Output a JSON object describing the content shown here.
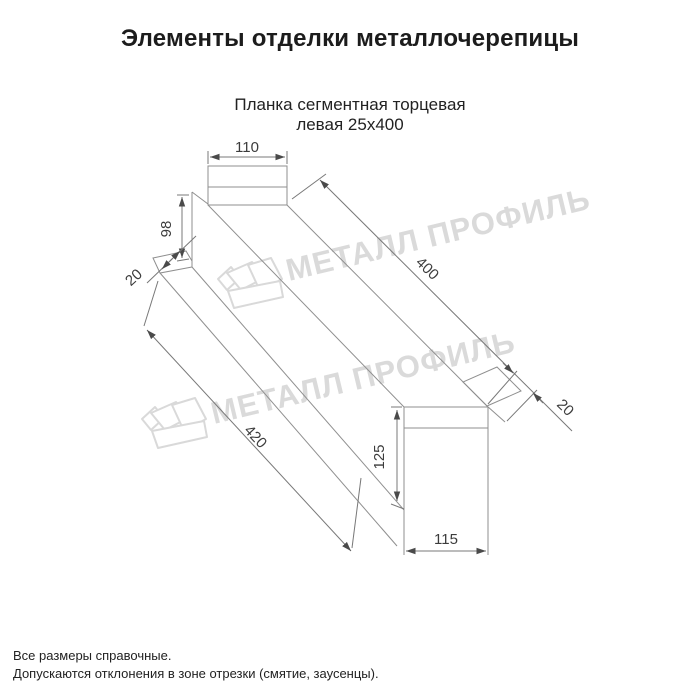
{
  "title": "Элементы отделки металлочерепицы",
  "subtitle": {
    "line1": "Планка сегментная торцевая",
    "line2": "левая 25х400"
  },
  "drawing": {
    "type": "technical-line-drawing",
    "part": "Планка сегментная торцевая левая 25х400",
    "dimensions": {
      "top_flange_width": "110",
      "left_end_height": "98",
      "left_end_fold": "20",
      "top_length": "400",
      "right_end_fold": "20",
      "bottom_length": "420",
      "right_end_height": "125",
      "bottom_flange_width": "115"
    },
    "line_color": "#8f8f8f",
    "dimension_color": "#787878"
  },
  "watermark": {
    "text": "МЕТАЛЛ ПРОФИЛЬ",
    "color": "#dadada",
    "logo": "metall-profil-crown-logo"
  },
  "footer": {
    "line1": "Все размеры справочные.",
    "line2": "Допускаются отклонения в зоне отрезки (смятие, заусенцы)."
  }
}
